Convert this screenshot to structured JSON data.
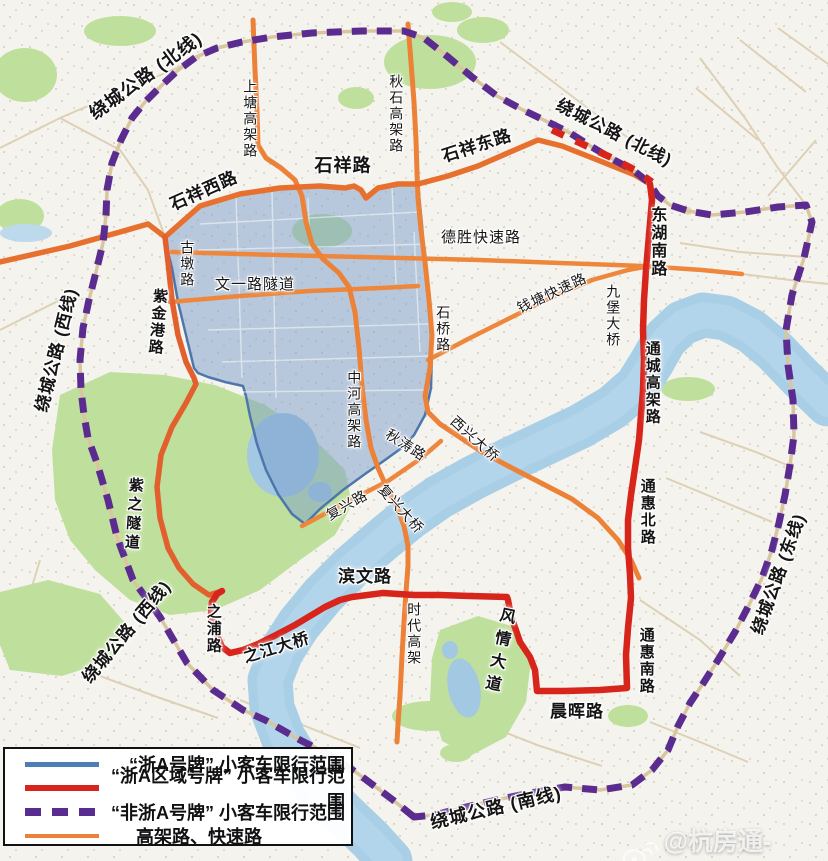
{
  "map": {
    "title": "杭州限行范围示意图",
    "colors": {
      "zheA_blue": "#4d7fb5",
      "regional_red": "#d7251c",
      "nonZheA_purple": "#5b2c90",
      "expressway_orange": "#ec8138",
      "zone_fill": "#7c9ecc",
      "river": "#a9cfe7",
      "park_green": "#bfe09c"
    },
    "legend": {
      "items": [
        {
          "type": "blue-solid",
          "color": "#4d7fb5",
          "label": "“浙A号牌” 小客车限行范围"
        },
        {
          "type": "red-solid",
          "color": "#d7251c",
          "label": "“浙A区域号牌” 小客车限行范围"
        },
        {
          "type": "purple-dashed",
          "color": "#5b2c90",
          "label": "“非浙A号牌” 小客车限行范围"
        },
        {
          "type": "orange-solid",
          "color": "#ec8138",
          "label": "高架路、快速路"
        }
      ]
    },
    "watermark": {
      "icon": "weibo-icon",
      "text": "@杭房通-Louis"
    },
    "labels": [
      {
        "text": "绕城公路 (北线)",
        "x": 146,
        "y": 76,
        "rot": -36,
        "bold": true,
        "size": 18
      },
      {
        "text": "绕城公路 (北线)",
        "x": 614,
        "y": 133,
        "rot": 27,
        "bold": true,
        "size": 17
      },
      {
        "text": "绕城公路 (西线)",
        "x": 57,
        "y": 350,
        "rot": -76,
        "bold": true,
        "size": 17
      },
      {
        "text": "绕城公路 (西线)",
        "x": 127,
        "y": 632,
        "rot": -50,
        "bold": true,
        "size": 17
      },
      {
        "text": "绕城公路 (东线)",
        "x": 779,
        "y": 574,
        "rot": -70,
        "bold": true,
        "size": 17
      },
      {
        "text": "绕城公路 (南线)",
        "x": 496,
        "y": 808,
        "rot": -13,
        "bold": true,
        "size": 18
      },
      {
        "text": "石祥西路",
        "x": 204,
        "y": 191,
        "rot": -24,
        "bold": true,
        "size": 17
      },
      {
        "text": "石祥路",
        "x": 343,
        "y": 166,
        "rot": 0,
        "bold": true,
        "size": 18
      },
      {
        "text": "石祥东路",
        "x": 477,
        "y": 146,
        "rot": -18,
        "bold": true,
        "size": 17
      },
      {
        "text": "秋石高架路",
        "x": 396,
        "y": 114,
        "v": true,
        "size": 14
      },
      {
        "text": "上塘高架路",
        "x": 250,
        "y": 119,
        "v": true,
        "size": 14
      },
      {
        "text": "古墩路",
        "x": 187,
        "y": 264,
        "v": true,
        "size": 14
      },
      {
        "text": "文一路隧道",
        "x": 255,
        "y": 285,
        "size": 15
      },
      {
        "text": "德胜快速路",
        "x": 481,
        "y": 238,
        "size": 15
      },
      {
        "text": "东湖南路",
        "x": 656,
        "y": 242,
        "v": true,
        "bold": true,
        "size": 16
      },
      {
        "text": "钱塘快速路",
        "x": 552,
        "y": 293,
        "rot": -25,
        "size": 14
      },
      {
        "text": "九堡大桥",
        "x": 613,
        "y": 316,
        "v": true,
        "size": 14
      },
      {
        "text": "通城高架路",
        "x": 652,
        "y": 383,
        "v": true,
        "bold": true,
        "size": 15
      },
      {
        "text": "通惠北路",
        "x": 647,
        "y": 512,
        "v": true,
        "bold": true,
        "size": 15
      },
      {
        "text": "通惠南路",
        "x": 646,
        "y": 661,
        "v": true,
        "bold": true,
        "size": 15
      },
      {
        "text": "晨晖路",
        "x": 577,
        "y": 712,
        "bold": true,
        "size": 17
      },
      {
        "text": "风情大道",
        "x": 497,
        "y": 652,
        "v": true,
        "rot": 12,
        "bold": true,
        "size": 16,
        "ls": 7
      },
      {
        "text": "滨文路",
        "x": 365,
        "y": 577,
        "bold": true,
        "size": 17
      },
      {
        "text": "时代高架",
        "x": 414,
        "y": 634,
        "v": true,
        "size": 14
      },
      {
        "text": "之浦路",
        "x": 213,
        "y": 629,
        "v": true,
        "bold": true,
        "size": 15
      },
      {
        "text": "之江大桥",
        "x": 277,
        "y": 649,
        "rot": -17,
        "bold": true,
        "size": 16
      },
      {
        "text": "紫金港路",
        "x": 157,
        "y": 322,
        "v": true,
        "rot": 5,
        "bold": true,
        "size": 15
      },
      {
        "text": "紫之隧道",
        "x": 133,
        "y": 515,
        "v": true,
        "rot": 4,
        "bold": true,
        "size": 15,
        "ls": 4
      },
      {
        "text": "中河高架路",
        "x": 354,
        "y": 410,
        "v": true,
        "size": 14
      },
      {
        "text": "石桥路",
        "x": 443,
        "y": 329,
        "v": true,
        "size": 14
      },
      {
        "text": "西兴大桥",
        "x": 475,
        "y": 439,
        "rot": 42,
        "size": 14
      },
      {
        "text": "秋涛路",
        "x": 406,
        "y": 445,
        "rot": 33,
        "size": 14
      },
      {
        "text": "复兴路",
        "x": 347,
        "y": 505,
        "rot": -30,
        "size": 14
      },
      {
        "text": "复兴大桥",
        "x": 401,
        "y": 509,
        "rot": 48,
        "size": 14
      }
    ]
  }
}
